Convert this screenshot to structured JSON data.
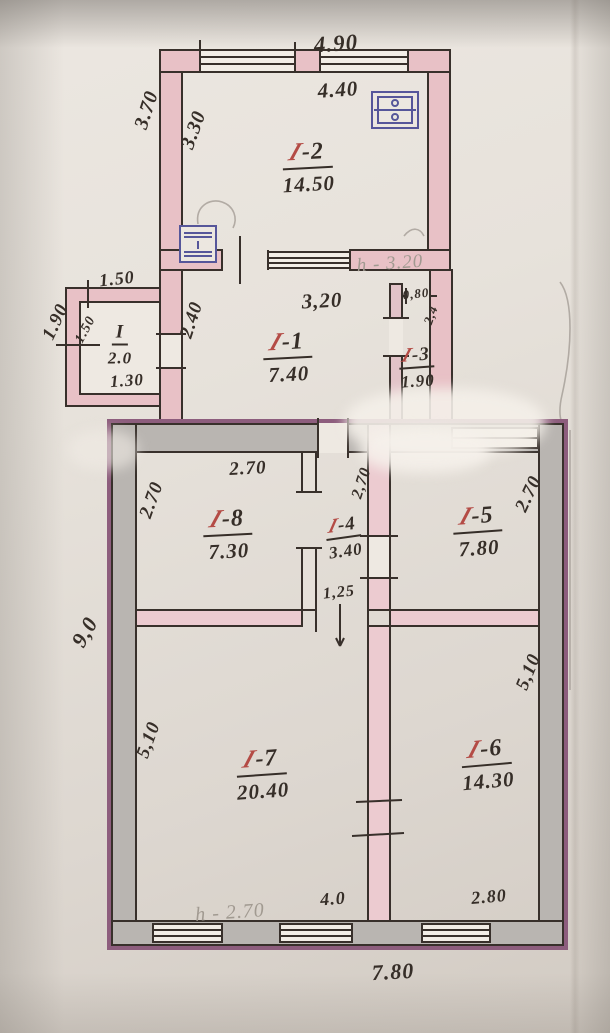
{
  "meta": {
    "type": "hand-drawn apartment floor plan (technical passport sketch)",
    "floors": "single level, two joined buildings"
  },
  "rooms": {
    "i2": {
      "id_slash": "I",
      "id_rest": "-2",
      "area": "14.50"
    },
    "i1": {
      "id_slash": "I",
      "id_rest": "-1",
      "area": "7.40"
    },
    "i3": {
      "id_slash": "I",
      "id_rest": "-3",
      "area": "1.90"
    },
    "i8": {
      "id_slash": "I",
      "id_rest": "-8",
      "area": "7.30"
    },
    "i4": {
      "id_slash": "I",
      "id_rest": "-4",
      "area": "3.40"
    },
    "i5": {
      "id_slash": "I",
      "id_rest": "-5",
      "area": "7.80"
    },
    "i7": {
      "id_slash": "I",
      "id_rest": "-7",
      "area": "20.40"
    },
    "i6": {
      "id_slash": "I",
      "id_rest": "-6",
      "area": "14.30"
    },
    "porch": {
      "id": "I",
      "area": "2.0"
    }
  },
  "dims": {
    "upper_top_outer": "4.90",
    "upper_top_inner": "4.40",
    "upper_left_outer": "3.70",
    "upper_left_inner": "3.30",
    "porch_top": "1.50",
    "porch_left_outer": "1.90",
    "porch_left_inner": "1.50",
    "porch_bottom": "1.30",
    "i1_left": "2.40",
    "i1_top": "3,20",
    "i3_door": "0,80",
    "i3_side": "2,4",
    "i8_top": "2.70",
    "i8_left": "2.70",
    "i4_side": "2,70",
    "i4_width": "1,25",
    "i5_right": "2.70",
    "lower_left_outer": "9,0",
    "i7_left": "5,10",
    "i7_bottom": "4.0",
    "i6_right": "5,10",
    "i6_bottom": "2.80",
    "lower_bottom_outer": "7.80"
  },
  "annotations": {
    "upper_height": "h - 3.20",
    "lower_height": "h - 2.70"
  },
  "icons": [
    {
      "name": "stove-icon",
      "room": "I-2",
      "position": "bottom-left"
    },
    {
      "name": "stove-icon",
      "room": "I-2",
      "position": "top-right"
    }
  ],
  "colors": {
    "paper": "#e7e2db",
    "ink": "#38302b",
    "wall_pink": "#e8c1c6",
    "wall_grey": "#b9b5b1",
    "wall_outline_purple": "#8d5d7d",
    "room_number_red": "#b44b45",
    "pencil": "#a19a91",
    "stove_blue": "#56569a"
  }
}
